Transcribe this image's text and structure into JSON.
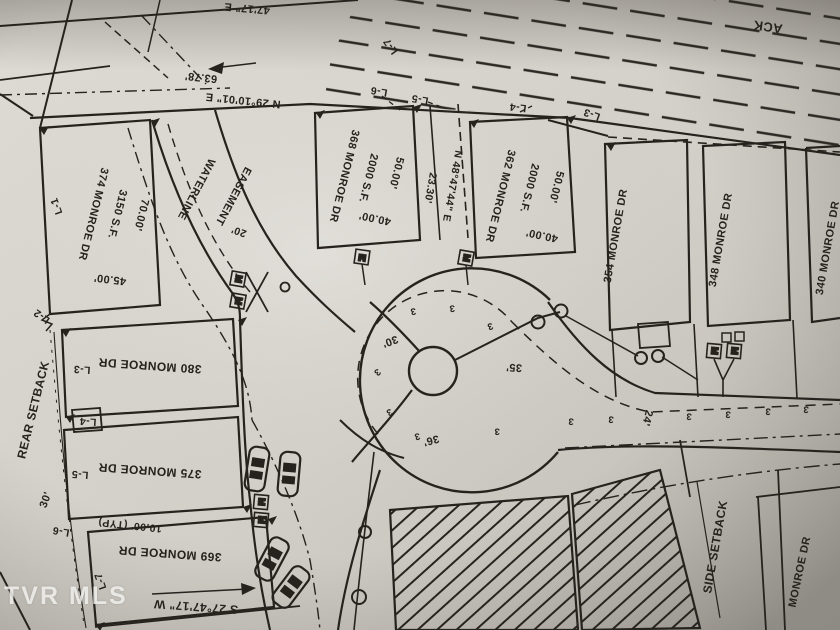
{
  "watermark": "TVR MLS",
  "street_name": "MONROE DR",
  "corner_partial": "ACK",
  "bearings": {
    "top_partial": "47'17\" E",
    "n29": "N 29°10'01\" E",
    "d6378": "63.78'",
    "n48": "N 48°47'44\" E",
    "d2330": "23.30'",
    "s27": "S 27°47'17\" W"
  },
  "lots": {
    "l374": {
      "address": "374 MONROE DR",
      "area": "3150 S.F.",
      "front": "70.00'",
      "side": "45.00'"
    },
    "l368": {
      "address": "368 MONROE DR",
      "area": "2000 S.F.",
      "front": "50.00'",
      "rear": "40.00'"
    },
    "l362": {
      "address": "362 MONROE DR",
      "area": "2000 S.F.",
      "front": "50.00'",
      "rear": "40.00'"
    },
    "l354": {
      "address": "354 MONROE DR"
    },
    "l348": {
      "address": "348 MONROE DR"
    },
    "l340": {
      "address": "340 MONROE DR"
    },
    "l380": {
      "address": "380 MONROE DR"
    },
    "l375": {
      "address": "375 MONROE DR"
    },
    "l369": {
      "address": "369 MONROE DR"
    }
  },
  "tags": {
    "t1": "L-1",
    "t2": "L-2",
    "t3": "L-3",
    "t4": "L-4",
    "t5": "L-5",
    "t6": "L-6",
    "t7": "L-7"
  },
  "easement": {
    "width": "20'",
    "w1": "WATERLINE",
    "w2": "EASEMENT"
  },
  "setbacks": {
    "rear": "REAR SETBACK",
    "rear_dim": "30'",
    "side": "SIDE SETBACK"
  },
  "dims": {
    "typ": "10.00' (TYP)",
    "r30": "30'",
    "r35": "35'",
    "r36": "36'",
    "w24": "24'"
  },
  "symbols": {
    "meter": "M",
    "three": "3"
  }
}
